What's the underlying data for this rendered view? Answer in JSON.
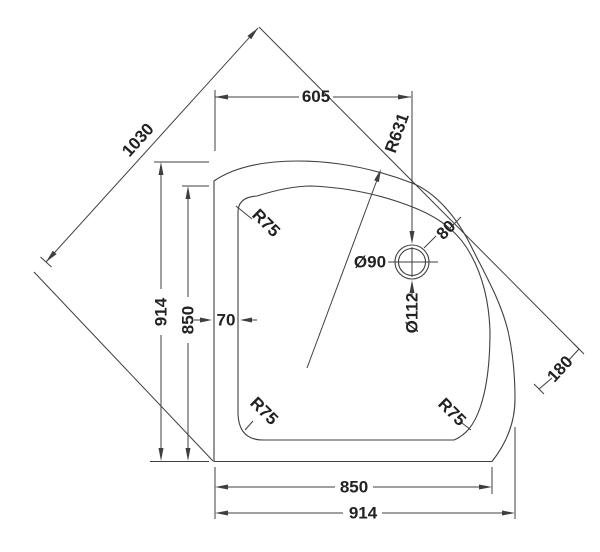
{
  "drawing": {
    "type": "technical-dimension-drawing",
    "subject": "quadrant-shower-tray-plan-view",
    "labels": {
      "top_width": "605",
      "diagonal": "1030",
      "front_radius": "R631",
      "corner_radius_top_left": "R75",
      "corner_radius_bottom_left": "R75",
      "corner_radius_bottom_right": "R75",
      "rim_width": "70",
      "side_outer": "914",
      "side_inner": "850",
      "bottom_inner": "850",
      "bottom_outer": "914",
      "waste_offset": "180",
      "waste_rim_gap": "80",
      "waste_diameter_outer": "Ø112",
      "waste_diameter_inner": "Ø90"
    },
    "colors": {
      "line": "#3f3f3f",
      "text": "#222222",
      "background": "#ffffff"
    }
  }
}
